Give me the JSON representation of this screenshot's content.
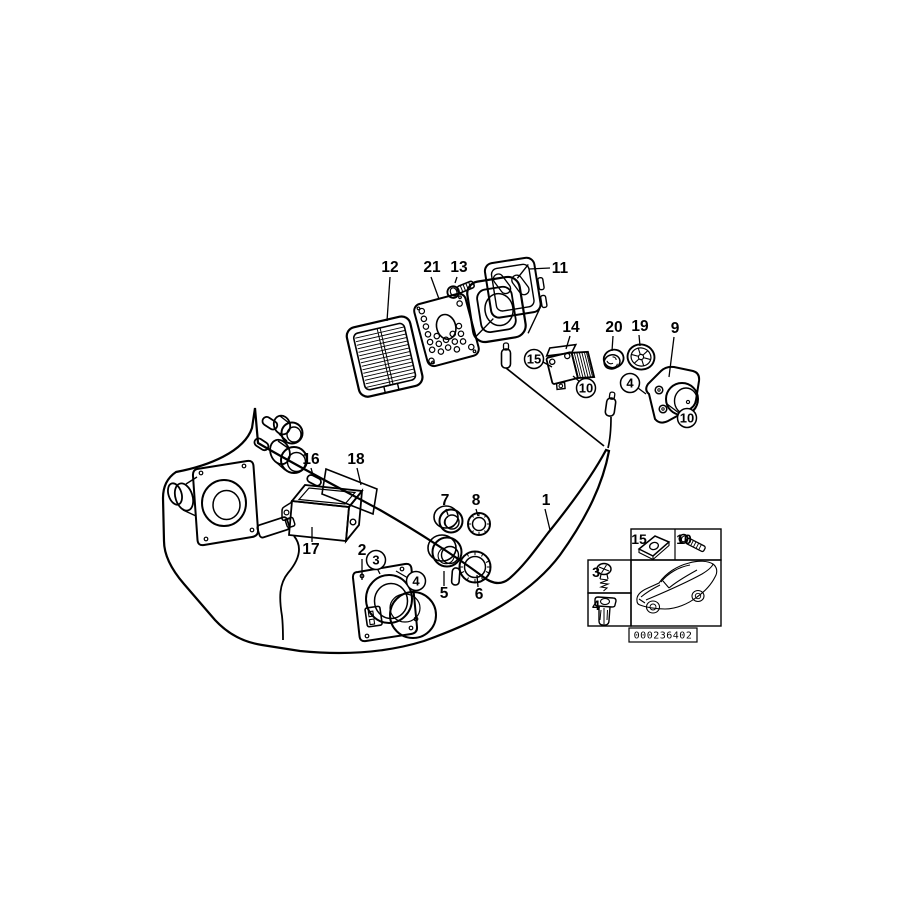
{
  "diagram": {
    "title": "parts-diagram",
    "background": "#ffffff",
    "line_color": "#000000",
    "callouts": [
      {
        "name": "callout-12",
        "label": "12",
        "x": 390,
        "y": 272,
        "style": "plain",
        "leader": [
          390,
          277,
          387,
          321
        ]
      },
      {
        "name": "callout-21",
        "label": "21",
        "x": 432,
        "y": 272,
        "style": "plain",
        "leader": [
          431,
          277,
          439,
          299
        ]
      },
      {
        "name": "callout-13",
        "label": "13",
        "x": 459,
        "y": 272,
        "style": "plain",
        "leader": [
          457,
          277,
          455,
          283
        ]
      },
      {
        "name": "callout-11",
        "label": "11",
        "x": 560,
        "y": 273,
        "style": "plain",
        "leader": [
          550,
          268,
          529,
          269
        ]
      },
      {
        "name": "callout-14",
        "label": "14",
        "x": 571,
        "y": 332,
        "style": "plain",
        "leader": [
          570,
          336,
          566,
          349
        ]
      },
      {
        "name": "callout-20",
        "label": "20",
        "x": 614,
        "y": 332,
        "style": "plain",
        "leader": [
          613,
          336,
          612,
          351
        ]
      },
      {
        "name": "callout-19",
        "label": "19",
        "x": 640,
        "y": 331,
        "style": "plain",
        "leader": [
          639,
          335,
          640,
          346
        ]
      },
      {
        "name": "callout-9",
        "label": "9",
        "x": 675,
        "y": 333,
        "style": "plain",
        "leader": [
          674,
          337,
          669,
          377
        ]
      },
      {
        "name": "callout-16",
        "label": "16",
        "x": 311,
        "y": 464,
        "style": "plain",
        "leader": [
          311,
          468,
          313,
          475
        ]
      },
      {
        "name": "callout-18",
        "label": "18",
        "x": 356,
        "y": 464,
        "style": "plain",
        "leader": [
          357,
          468,
          361,
          485
        ]
      },
      {
        "name": "callout-17",
        "label": "17",
        "x": 311,
        "y": 554,
        "style": "plain",
        "leader": [
          312,
          542,
          312,
          527
        ]
      },
      {
        "name": "callout-2",
        "label": "2",
        "x": 362,
        "y": 555,
        "style": "plain",
        "leader": [
          362,
          559,
          362,
          580
        ]
      },
      {
        "name": "callout-7",
        "label": "7",
        "x": 445,
        "y": 505,
        "style": "plain",
        "leader": [
          446,
          509,
          448,
          515
        ]
      },
      {
        "name": "callout-8",
        "label": "8",
        "x": 476,
        "y": 505,
        "style": "plain",
        "leader": [
          476,
          509,
          478,
          516
        ]
      },
      {
        "name": "callout-5",
        "label": "5",
        "x": 444,
        "y": 598,
        "style": "plain",
        "leader": [
          444,
          586,
          444,
          571
        ]
      },
      {
        "name": "callout-6",
        "label": "6",
        "x": 479,
        "y": 599,
        "style": "plain",
        "leader": [
          478,
          587,
          477,
          575
        ]
      },
      {
        "name": "callout-1",
        "label": "1",
        "x": 546,
        "y": 505,
        "style": "plain",
        "leader": [
          545,
          509,
          550,
          530
        ]
      },
      {
        "name": "callout-15-circled",
        "label": "15",
        "x": 534,
        "y": 359,
        "style": "circled",
        "leader": [
          543,
          362,
          552,
          367
        ]
      },
      {
        "name": "callout-10-circled-module",
        "label": "10",
        "x": 586,
        "y": 388,
        "style": "circled",
        "leader": [
          580,
          382,
          573,
          376
        ]
      },
      {
        "name": "callout-4-circled-pod",
        "label": "4",
        "x": 630,
        "y": 383,
        "style": "circled",
        "leader": [
          638,
          388,
          646,
          394
        ]
      },
      {
        "name": "callout-10-circled-pod",
        "label": "10",
        "x": 687,
        "y": 418,
        "style": "circled",
        "leader": [
          679,
          413,
          667,
          404
        ]
      },
      {
        "name": "callout-3-circled",
        "label": "3",
        "x": 376,
        "y": 560,
        "style": "circled",
        "leader": [
          377,
          568,
          380,
          574
        ]
      },
      {
        "name": "callout-4-circled-speaker",
        "label": "4",
        "x": 416,
        "y": 581,
        "style": "circled",
        "leader": [
          408,
          578,
          396,
          571
        ]
      },
      {
        "name": "inset-label-15",
        "label": "15",
        "x": 639,
        "y": 544,
        "style": "inset"
      },
      {
        "name": "inset-label-10",
        "label": "10",
        "x": 684,
        "y": 544,
        "style": "inset"
      },
      {
        "name": "inset-label-3",
        "label": "3",
        "x": 596,
        "y": 577,
        "style": "inset"
      },
      {
        "name": "inset-label-4",
        "label": "4",
        "x": 596,
        "y": 610,
        "style": "inset"
      }
    ],
    "inset": {
      "code": "000236402"
    }
  }
}
